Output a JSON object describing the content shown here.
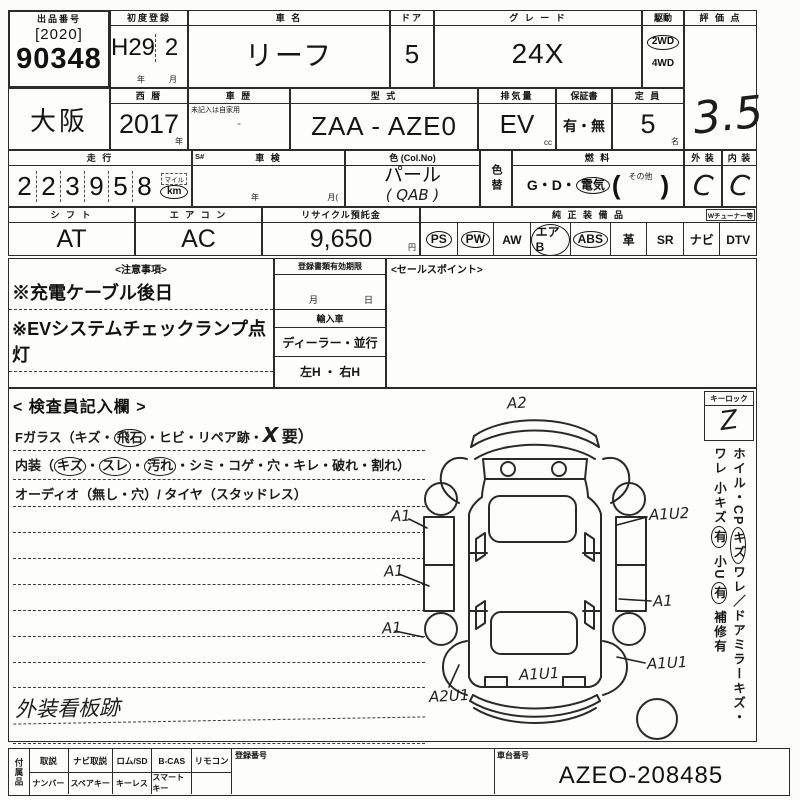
{
  "colors": {
    "paper": "#fcfcfa",
    "ink": "#2b2b2b",
    "hand_ink": "#1c1c1c"
  },
  "header": {
    "auction_no_label": "出品番号",
    "lot_year": "[2020]",
    "lot_number": "90348",
    "first_reg_label": "初度登録",
    "first_reg_year": "H29",
    "first_reg_month": "2",
    "unit_year": "年",
    "unit_month": "月",
    "car_name_label": "車 名",
    "car_name": "リーフ",
    "door_label": "ドア",
    "door_count": "5",
    "grade_label": "グ レ ー ド",
    "grade": "24X",
    "drive_label": "駆動",
    "drive_selected": "2WD",
    "drive_other": "4WD",
    "score_label": "評 価 点",
    "score": "3.5"
  },
  "row2": {
    "region": "大阪",
    "calendar_label": "西 暦",
    "calendar_year": "2017",
    "unit_year": "年",
    "history_label": "車 歴",
    "history_note": "未記入は自家用",
    "model_label": "型 式",
    "model": "ZAA - AZE0",
    "displacement_label": "排気量",
    "displacement": "EV",
    "unit_cc": "cc",
    "warranty_label": "保証書",
    "warranty_options": "有・無",
    "capacity_label": "定 員",
    "capacity": "5",
    "unit_name": "名"
  },
  "row3": {
    "mileage_label": "走 行",
    "mileage_digits": [
      "2",
      "2",
      "3",
      "9",
      "5",
      "8"
    ],
    "mile_unit": "マイル",
    "km_unit": "km",
    "s_mark": "S#",
    "shaken_label": "車 検",
    "shaken_year_unit": "年",
    "shaken_month_unit": "月(",
    "color_label": "色 (Col.No)",
    "color_name": "パール",
    "color_code": "(  QAB  )",
    "color_change_label": "色替",
    "fuel_label": "燃 料",
    "fuel_prefix": "G・D・",
    "fuel_electric": "電気",
    "fuel_paren_open": "(",
    "fuel_other_label": "その他",
    "fuel_paren_close": ")",
    "exterior_label": "外 装",
    "exterior_grade": "C",
    "interior_label": "内 装",
    "interior_grade": "C"
  },
  "row4": {
    "shift_label": "シ フ ト",
    "shift_value": "AT",
    "aircon_label": "エ ア コ ン",
    "aircon_value": "AC",
    "recycle_label": "リサイクル預託金",
    "recycle_value": "9,650",
    "unit_yen": "円",
    "equipment_label": "純 正 装 備 品",
    "tuner_label": "Wチューナー等",
    "equipment": [
      {
        "label": "PS",
        "circled": true
      },
      {
        "label": "PW",
        "circled": true
      },
      {
        "label": "AW",
        "circled": false
      },
      {
        "label": "エアB",
        "circled": true
      },
      {
        "label": "ABS",
        "circled": true
      },
      {
        "label": "革",
        "circled": false
      },
      {
        "label": "SR",
        "circled": false
      },
      {
        "label": "ナビ",
        "circled": false
      },
      {
        "label": "DTV",
        "circled": false
      }
    ]
  },
  "notes": {
    "title": "<注意事項>",
    "lines": [
      "※充電ケーブル後日",
      "※EVシステムチェックランプ点灯"
    ]
  },
  "registration": {
    "title": "登録書類有効期限",
    "month_unit": "月",
    "day_unit": "日",
    "import_label": "輸入車",
    "dealer_parallel": "ディーラー・並行",
    "handle": "左H ・ 右H"
  },
  "sales": {
    "title": "<セールスポイント>"
  },
  "inspector": {
    "title": "< 検査員記入欄 >",
    "glass_pre": "Fガラス（キズ・",
    "glass_circled": "飛石",
    "glass_mid": "・ヒビ・リペア跡・",
    "glass_mark": "X",
    "glass_end": "要）",
    "interior_pre": "内装（",
    "interior_c1": "キズ",
    "sep1": "・",
    "interior_c2": "スレ",
    "sep2": "・",
    "interior_c3": "汚れ",
    "interior_end": "・シミ・コゲ・穴・キレ・破れ・割れ）",
    "audio_line": "オーディオ（無し・穴）/ タイヤ（スタッドレス）",
    "hand_note1": "外装看板跡",
    "hand_note2": "シート ヘタリ"
  },
  "keylock": {
    "label": "キーロック",
    "mark": "Z"
  },
  "side_note": {
    "a": "ホイル・CP",
    "b": "キズ",
    "c": "ワレ／ドアミラーキズ・ワレ",
    "d": "小キズ",
    "e": "有",
    "f": "小U",
    "g": "有",
    "h": "補修有"
  },
  "diagram": {
    "annotations": [
      {
        "label": "A2",
        "x": 128,
        "y": 5
      },
      {
        "label": "A1",
        "x": 12,
        "y": 118
      },
      {
        "label": "A1U2",
        "x": 270,
        "y": 116
      },
      {
        "label": "A1",
        "x": 5,
        "y": 173
      },
      {
        "label": "A1",
        "x": 274,
        "y": 203
      },
      {
        "label": "A1",
        "x": 3,
        "y": 230
      },
      {
        "label": "A1U1",
        "x": 268,
        "y": 265
      },
      {
        "label": "A1U1",
        "x": 140,
        "y": 276
      },
      {
        "label": "A2U1",
        "x": 50,
        "y": 298
      }
    ]
  },
  "bottom": {
    "side_label": "付属品",
    "row1": [
      "取説",
      "ナビ取説",
      "ロム/SD",
      "B-CAS",
      "リモコン"
    ],
    "row2": [
      "ナンバー",
      "スペアキー",
      "キーレス",
      "スマートキー"
    ],
    "reg_no_label": "登録番号",
    "chassis_label": "車台番号",
    "chassis_no": "AZEO-208485"
  }
}
